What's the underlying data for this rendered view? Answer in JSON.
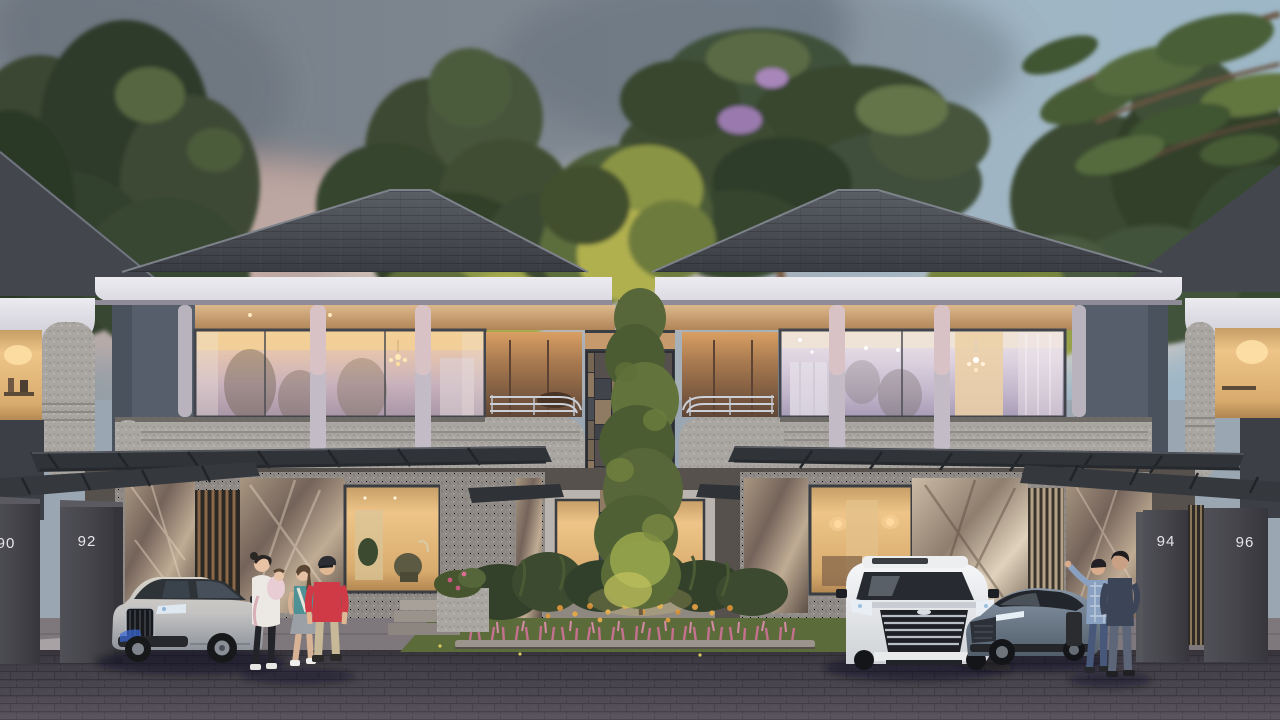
{
  "scene": {
    "description": "Twilight architectural rendering of modern two-storey terrace houses with glowing interiors, carports, a landscaped centre garden, parked cars and residents",
    "house_numbers": [
      "90",
      "92",
      "94",
      "96"
    ],
    "palette": {
      "sky_left": "#949da5",
      "sky_right": "#9db6c6",
      "sunset_pink": "#d9a89d",
      "roof": "#43464c",
      "fascia_white": "#e6e5ea",
      "wall_blue_grey": "#5a636e",
      "stone_speckle": "#a9a6a2",
      "glass_warm": "#eec488",
      "glass_cool": "#d8cede",
      "marble": "#9a8672",
      "canopy": "#303338",
      "pillar": "#46464c",
      "number_text": "#e6e4ea",
      "road_brick": "#49454e",
      "grass": "#5c6b3a",
      "flower_pink": "#c4718f",
      "flower_orange": "#d28f3a",
      "tree_green": "#44533a"
    },
    "vehicles": [
      {
        "name": "silver-suv",
        "color": "#c3c6cc"
      },
      {
        "name": "white-mpv",
        "color": "#f0f2f4"
      },
      {
        "name": "grey-blue-sedan",
        "color": "#76848f"
      }
    ],
    "people": [
      "woman-carrying-child",
      "girl",
      "man-in-red-shirt",
      "man-in-plaid-shirt",
      "man-in-navy-shirt"
    ]
  }
}
